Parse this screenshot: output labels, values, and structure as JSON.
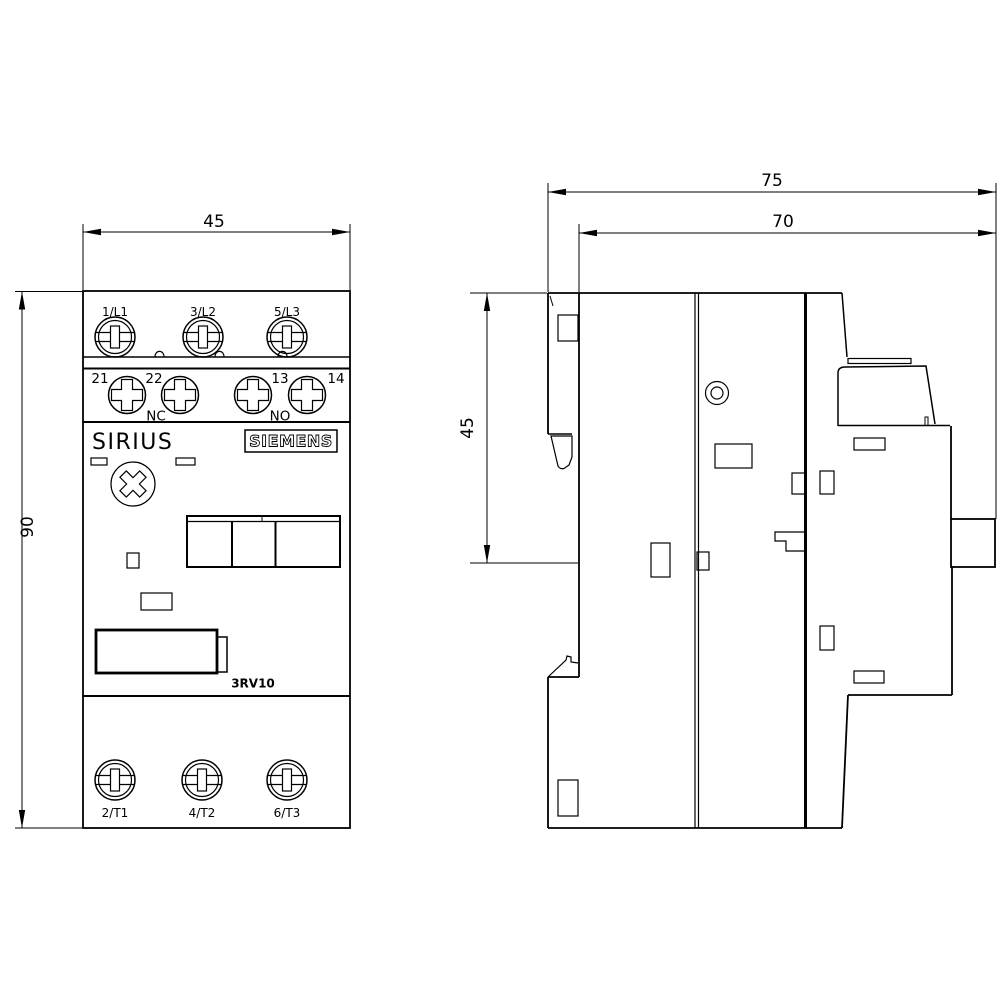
{
  "front_view": {
    "dim_width": "45",
    "dim_height": "90",
    "line_terminals": [
      "1/L1",
      "3/L2",
      "5/L3"
    ],
    "aux_terminals": [
      "21",
      "22",
      "13",
      "14"
    ],
    "aux_nc": "NC",
    "aux_no": "NO",
    "brand": "SIRIUS",
    "logo": "SIEMENS",
    "model": "3RV10",
    "load_terminals": [
      "2/T1",
      "4/T2",
      "6/T3"
    ]
  },
  "side_view": {
    "dim_total_depth": "75",
    "dim_body_depth": "70",
    "dim_mount_height": "45"
  }
}
